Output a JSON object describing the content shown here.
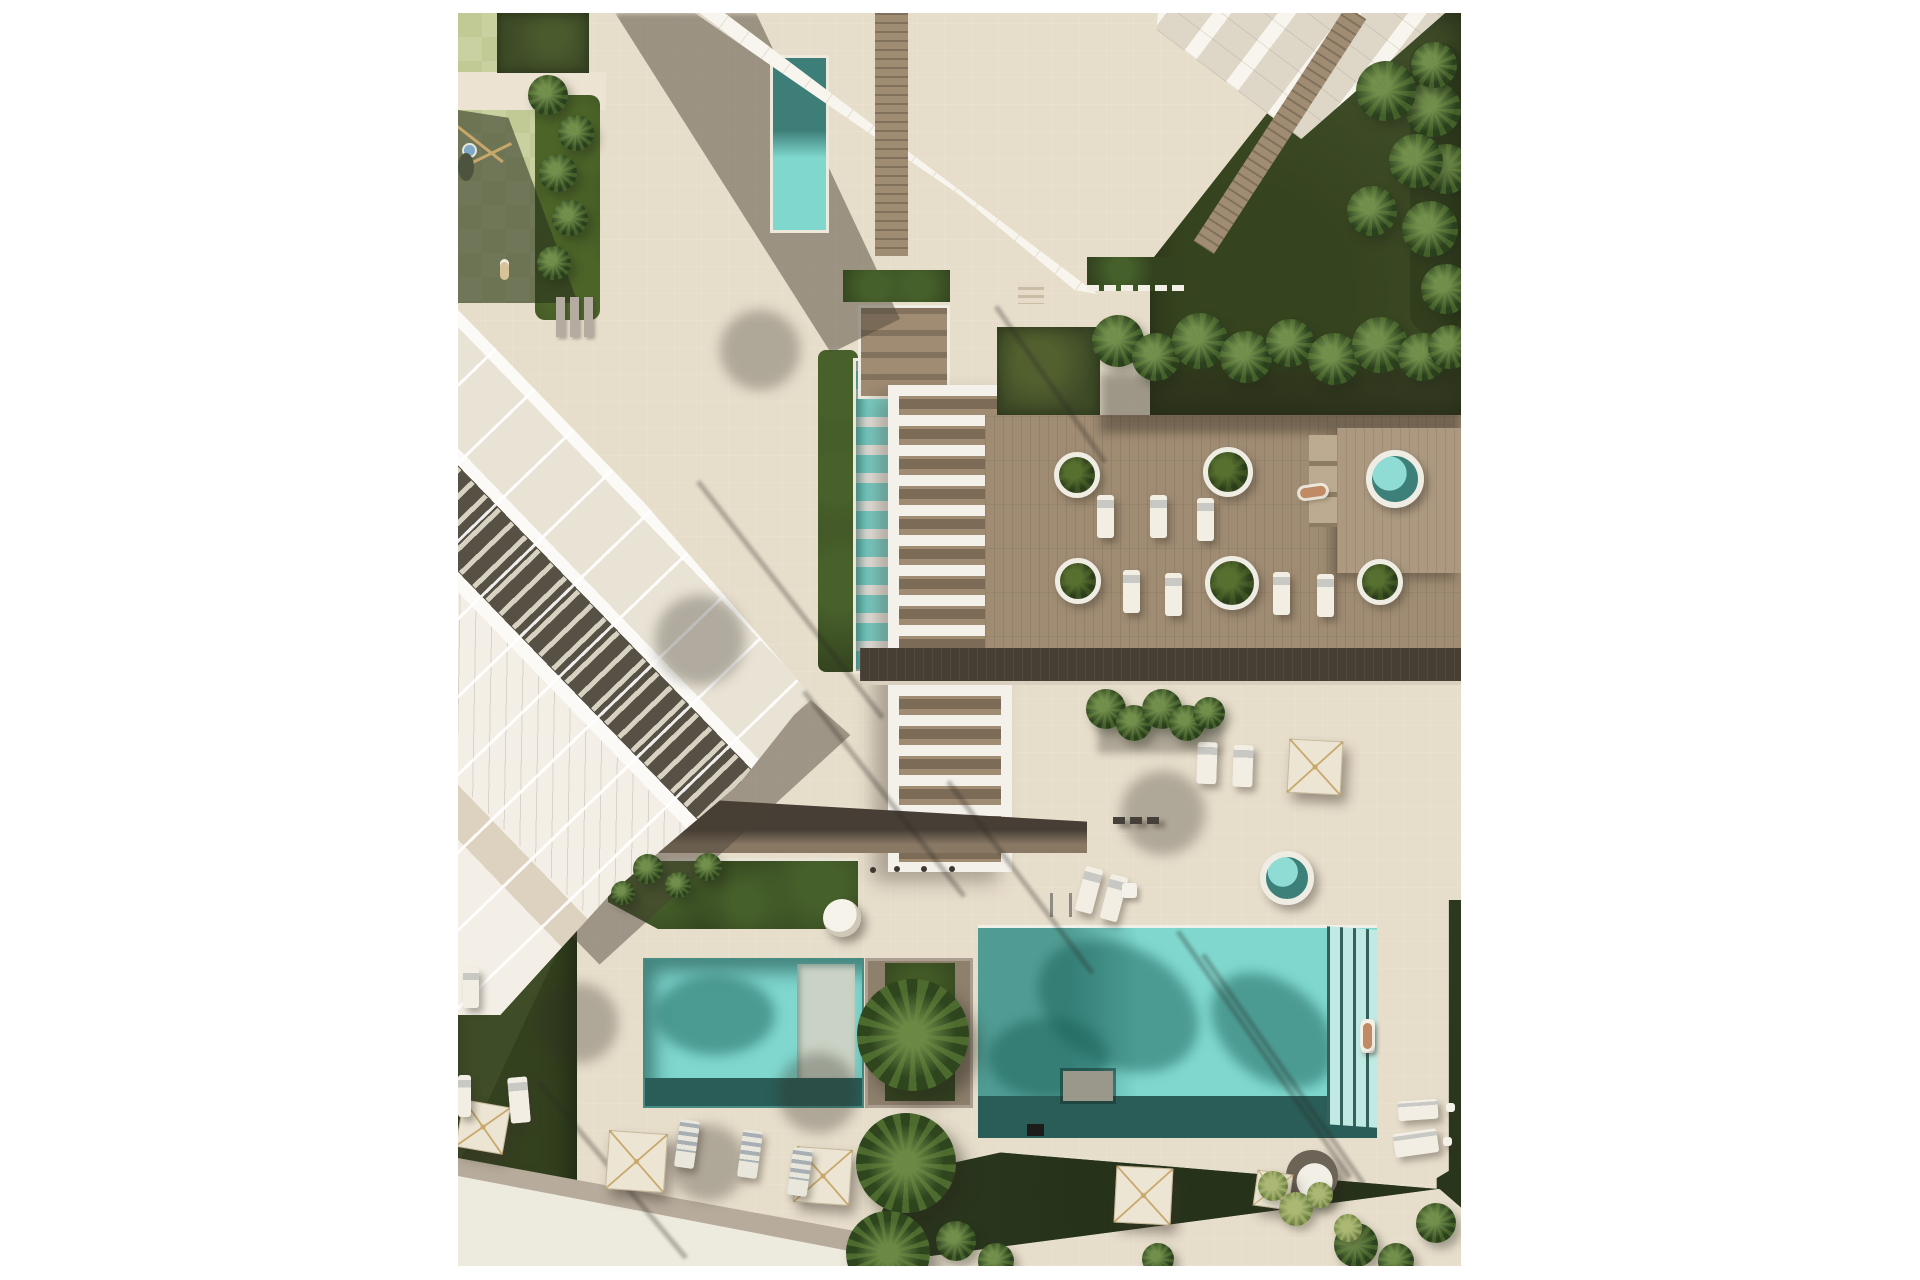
{
  "colors": {
    "paper": "#ffffff",
    "pave": "#e7ddcb",
    "pave-light": "#ece3d2",
    "sidewalk": "#edeade",
    "sidewalk-shadow": "#b7ac9c",
    "water": "#7fd7ce",
    "water-dark": "#2a5d58",
    "water-shadow": "#3c8b83",
    "water-step": "#bfe9e2",
    "wood": "#a08c73",
    "wood-dark": "#473f34",
    "path-brown": "#5f5448",
    "grass": "#3f4c28",
    "grass-dark": "#2c381f",
    "lime": "#cad1a1",
    "lime2": "#c1c995",
    "hedge": "#33431f",
    "leaf": "#55702f",
    "leaf-light": "#93a35e",
    "bldg": "#f5f2ea",
    "glass": "#ded7c8",
    "roof-dark": "#575145",
    "umbrella": "#ece5d3",
    "uframe": "#c8a76b",
    "lounger": "#f2eee3",
    "spa": "#6fd0c9",
    "skin": "#c08a64"
  },
  "scene": {
    "tshadows": [
      {
        "x": 242,
        "y": 467,
        "l": 300,
        "rot": 52
      },
      {
        "x": 348,
        "y": 677,
        "l": 260,
        "rot": 52
      },
      {
        "x": 492,
        "y": 767,
        "l": 240,
        "rot": 53
      },
      {
        "x": 722,
        "y": 917,
        "l": 300,
        "rot": 55
      },
      {
        "x": 747,
        "y": 940,
        "l": 280,
        "rot": 55
      },
      {
        "x": 82,
        "y": 1067,
        "l": 230,
        "rot": 50
      },
      {
        "x": 540,
        "y": 292,
        "l": 190,
        "rot": 55
      }
    ],
    "fshadows": [
      {
        "x": 242,
        "y": 627,
        "r": 45
      },
      {
        "x": 302,
        "y": 337,
        "r": 40
      },
      {
        "x": 120,
        "y": 1010,
        "r": 40
      },
      {
        "x": 360,
        "y": 1080,
        "r": 40
      },
      {
        "x": 250,
        "y": 1150,
        "r": 38
      },
      {
        "x": 705,
        "y": 800,
        "r": 42
      }
    ],
    "umbrellas": [
      {
        "x": 830,
        "y": 727,
        "s": 52,
        "rot": 3
      },
      {
        "x": 1,
        "y": 1090,
        "s": 46,
        "rot": 10
      },
      {
        "x": 149,
        "y": 1119,
        "s": 57,
        "rot": 4
      },
      {
        "x": 337,
        "y": 1135,
        "s": 54,
        "rot": 4
      },
      {
        "x": 657,
        "y": 1154,
        "s": 55,
        "rot": 3
      },
      {
        "x": 797,
        "y": 1159,
        "s": 34,
        "rot": 8
      }
    ],
    "planters": [
      {
        "x": 619,
        "y": 462,
        "r": 23
      },
      {
        "x": 620,
        "y": 568,
        "r": 23
      },
      {
        "x": 770,
        "y": 459,
        "r": 25
      },
      {
        "x": 774,
        "y": 570,
        "r": 27
      },
      {
        "x": 922,
        "y": 569,
        "r": 23
      }
    ],
    "loungers": [
      {
        "x": 639,
        "y": 482,
        "w": 17,
        "h": 43,
        "rot": 0
      },
      {
        "x": 692,
        "y": 482,
        "w": 17,
        "h": 43,
        "rot": 0
      },
      {
        "x": 739,
        "y": 485,
        "w": 17,
        "h": 43,
        "rot": 0
      },
      {
        "x": 665,
        "y": 557,
        "w": 17,
        "h": 43,
        "rot": 0
      },
      {
        "x": 707,
        "y": 560,
        "w": 17,
        "h": 43,
        "rot": 0
      },
      {
        "x": 815,
        "y": 559,
        "w": 17,
        "h": 43,
        "rot": 0
      },
      {
        "x": 859,
        "y": 561,
        "w": 17,
        "h": 43,
        "rot": 0
      },
      {
        "x": 622,
        "y": 854,
        "w": 18,
        "h": 46,
        "rot": 15
      },
      {
        "x": 647,
        "y": 862,
        "w": 18,
        "h": 46,
        "rot": 15
      },
      {
        "x": 739,
        "y": 729,
        "w": 20,
        "h": 42,
        "rot": 2
      },
      {
        "x": 775,
        "y": 732,
        "w": 20,
        "h": 42,
        "rot": 2
      },
      {
        "x": 5,
        "y": 955,
        "w": 16,
        "h": 40,
        "rot": 0
      },
      {
        "x": 51,
        "y": 1064,
        "w": 20,
        "h": 46,
        "rot": -5
      },
      {
        "x": 0,
        "y": 1062,
        "w": 13,
        "h": 42,
        "rot": 0
      },
      {
        "x": 940,
        "y": 1087,
        "w": 40,
        "h": 20,
        "rot": -4
      },
      {
        "x": 936,
        "y": 1118,
        "w": 44,
        "h": 24,
        "rot": -8
      }
    ],
    "gloungers": [
      {
        "x": 219,
        "y": 1107,
        "rot": 8
      },
      {
        "x": 282,
        "y": 1117,
        "rot": 8
      },
      {
        "x": 332,
        "y": 1135,
        "rot": 8
      }
    ],
    "tables": [
      {
        "x": 664,
        "y": 870,
        "s": 15
      },
      {
        "x": 988,
        "y": 1090,
        "s": 9
      },
      {
        "x": 985,
        "y": 1124,
        "s": 9
      }
    ],
    "persons": [
      {
        "x": 842,
        "y": 474,
        "w": 26,
        "h": 10,
        "rot": -8
      },
      {
        "x": 905,
        "y": 1010,
        "w": 9,
        "h": 26,
        "rot": 0
      }
    ],
    "palms": [
      {
        "x": 455,
        "y": 1022,
        "r": 56
      },
      {
        "x": 448,
        "y": 1150,
        "r": 50
      },
      {
        "x": 430,
        "y": 1240,
        "r": 42
      }
    ],
    "leafc": [
      {
        "x": 660,
        "y": 328,
        "r": 26
      },
      {
        "x": 698,
        "y": 344,
        "r": 24
      },
      {
        "x": 742,
        "y": 328,
        "r": 28
      },
      {
        "x": 788,
        "y": 344,
        "r": 26
      },
      {
        "x": 832,
        "y": 330,
        "r": 24
      },
      {
        "x": 876,
        "y": 346,
        "r": 26
      },
      {
        "x": 922,
        "y": 332,
        "r": 28
      },
      {
        "x": 964,
        "y": 344,
        "r": 24
      },
      {
        "x": 992,
        "y": 334,
        "r": 22
      },
      {
        "x": 648,
        "y": 696,
        "r": 20
      },
      {
        "x": 676,
        "y": 710,
        "r": 18
      },
      {
        "x": 704,
        "y": 696,
        "r": 20
      },
      {
        "x": 729,
        "y": 710,
        "r": 18
      },
      {
        "x": 751,
        "y": 700,
        "r": 16
      },
      {
        "x": 190,
        "y": 856,
        "r": 15
      },
      {
        "x": 220,
        "y": 872,
        "r": 13
      },
      {
        "x": 250,
        "y": 854,
        "r": 14
      },
      {
        "x": 165,
        "y": 880,
        "r": 12
      },
      {
        "x": 975,
        "y": 96,
        "r": 28
      },
      {
        "x": 988,
        "y": 156,
        "r": 25
      },
      {
        "x": 972,
        "y": 216,
        "r": 28
      },
      {
        "x": 988,
        "y": 276,
        "r": 25
      },
      {
        "x": 976,
        "y": 52,
        "r": 23
      },
      {
        "x": 928,
        "y": 78,
        "r": 30
      },
      {
        "x": 958,
        "y": 148,
        "r": 27
      },
      {
        "x": 914,
        "y": 198,
        "r": 25
      },
      {
        "x": 498,
        "y": 1228,
        "r": 20
      },
      {
        "x": 538,
        "y": 1248,
        "r": 18
      },
      {
        "x": 898,
        "y": 1232,
        "r": 22
      },
      {
        "x": 938,
        "y": 1248,
        "r": 18
      },
      {
        "x": 700,
        "y": 1246,
        "r": 16
      },
      {
        "x": 978,
        "y": 1210,
        "r": 20
      },
      {
        "x": 90,
        "y": 82,
        "r": 20
      },
      {
        "x": 118,
        "y": 120,
        "r": 18
      },
      {
        "x": 100,
        "y": 160,
        "r": 19
      },
      {
        "x": 112,
        "y": 205,
        "r": 18
      },
      {
        "x": 96,
        "y": 250,
        "r": 17
      }
    ],
    "leafl": [
      {
        "x": 815,
        "y": 1173,
        "r": 15
      },
      {
        "x": 838,
        "y": 1196,
        "r": 17
      },
      {
        "x": 862,
        "y": 1182,
        "r": 13
      },
      {
        "x": 890,
        "y": 1215,
        "r": 14
      }
    ],
    "bollards": [
      {
        "x": 412,
        "y": 854
      },
      {
        "x": 436,
        "y": 853
      },
      {
        "x": 463,
        "y": 853
      },
      {
        "x": 491,
        "y": 853
      }
    ],
    "dashes": [
      {
        "x": 655,
        "y": 804
      },
      {
        "x": 672,
        "y": 804
      },
      {
        "x": 689,
        "y": 804
      }
    ],
    "benches": [
      {
        "x": 98,
        "y": 284
      },
      {
        "x": 112,
        "y": 284
      },
      {
        "x": 126,
        "y": 284
      }
    ]
  }
}
